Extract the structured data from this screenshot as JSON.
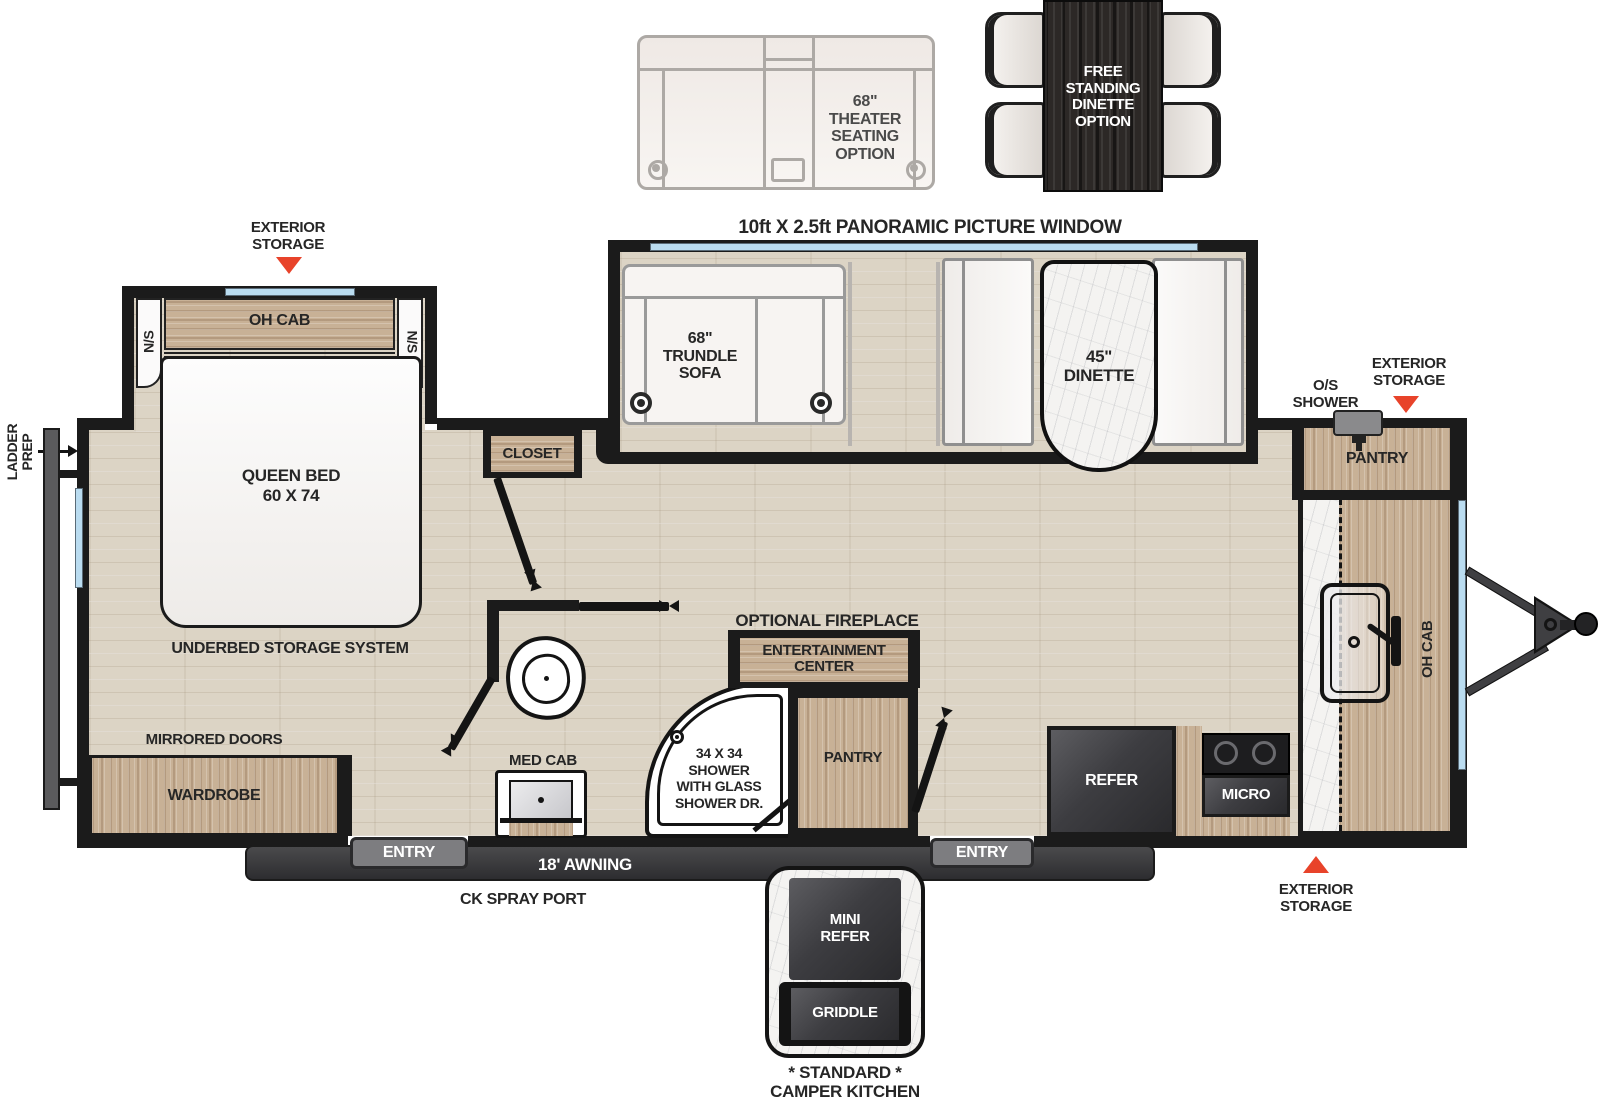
{
  "colors": {
    "accent_red": "#e8432a",
    "wall": "#1b1b1b",
    "window_blue": "#badcf0"
  },
  "options_top": {
    "theater_seating": "68\"\nTHEATER\nSEATING\nOPTION",
    "free_standing_dinette": "FREE\nSTANDING\nDINETTE\nOPTION"
  },
  "exterior": {
    "storage_bedroom": "EXTERIOR\nSTORAGE",
    "storage_front": "EXTERIOR\nSTORAGE",
    "storage_rear": "EXTERIOR\nSTORAGE",
    "os_shower": "O/S\nSHOWER",
    "ladder_prep": "LADDER\nPREP",
    "awning": "18' AWNING",
    "ck_spray_port": "CK SPRAY PORT",
    "entry": "ENTRY"
  },
  "living": {
    "panoramic_window": "10ft X 2.5ft PANORAMIC PICTURE WINDOW",
    "trundle_sofa": "68\"\nTRUNDLE\nSOFA",
    "dinette": "45\"\nDINETTE",
    "optional_fireplace": "OPTIONAL FIREPLACE",
    "entertainment_center": "ENTERTAINMENT\nCENTER",
    "pantry": "PANTRY"
  },
  "bedroom": {
    "oh_cab": "OH CAB",
    "ns": "N/S",
    "queen_bed": "QUEEN BED\n60 X 74",
    "underbed": "UNDERBED STORAGE SYSTEM",
    "mirrored_doors": "MIRRORED DOORS",
    "wardrobe": "WARDROBE",
    "closet": "CLOSET"
  },
  "bath": {
    "med_cab": "MED CAB",
    "shower": "34 X 34\nSHOWER\nWITH GLASS\nSHOWER DR."
  },
  "kitchen": {
    "pantry": "PANTRY",
    "refer": "REFER",
    "micro": "MICRO",
    "oh_cab": "OH CAB"
  },
  "camper_kitchen": {
    "mini_refer": "MINI\nREFER",
    "griddle": "GRIDDLE",
    "caption": "* STANDARD *\nCAMPER KITCHEN"
  }
}
